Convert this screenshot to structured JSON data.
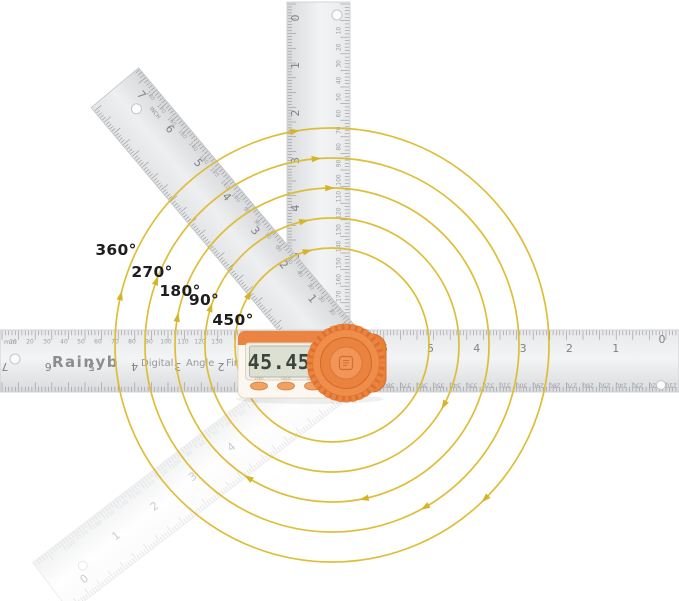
{
  "brand": {
    "name": "Rainyb",
    "descriptor": [
      "Digital",
      "Angle",
      "Finder"
    ]
  },
  "display": {
    "value": "45.45",
    "unit": "°"
  },
  "device_buttons": [
    {
      "label": "ZERO"
    },
    {
      "label": "HOLD"
    },
    {
      "label": "ON/OFF"
    }
  ],
  "rotation_labels": [
    "360°",
    "270°",
    "180°",
    "90°",
    "450°"
  ],
  "colors": {
    "arc_yellow": "#dcba2e",
    "arrow_yellow": "#d6b42a",
    "device_orange": "#ea8440",
    "lcd_screen": "#dce0d3",
    "steel_tick": "#94979b",
    "label_text": "#1e1e1e"
  },
  "rulers": {
    "horizontal": {
      "unit_label": "mm",
      "mm_top": [
        10,
        20,
        30,
        40,
        50,
        60,
        70,
        80,
        90,
        100,
        110,
        120,
        130
      ],
      "inch_right": [
        6,
        5,
        4,
        3,
        2,
        1,
        0
      ],
      "inch_left_flipped": [
        7,
        6,
        5,
        4,
        3,
        2
      ],
      "mm_bottom_flipped": [
        210,
        220,
        230,
        240,
        250,
        260,
        270,
        280,
        290,
        300,
        310,
        320,
        330,
        340,
        350,
        360,
        370,
        380
      ]
    },
    "vertical": {
      "inch": [
        0,
        1,
        2,
        3,
        4,
        5
      ],
      "mm": [
        10,
        20,
        30,
        40,
        50,
        60,
        70,
        80,
        90,
        100,
        110,
        120,
        130,
        140,
        150,
        160,
        170,
        180,
        190
      ]
    },
    "diagonal": {
      "unit_label": "INCH",
      "inch": [
        1,
        2,
        3,
        4,
        5,
        6,
        7
      ],
      "mm": [
        10,
        20,
        30,
        40,
        50,
        60,
        70,
        80,
        90,
        100,
        110,
        120,
        130,
        140,
        150,
        160,
        170,
        180
      ]
    },
    "ghost": {
      "inch": [
        0,
        1,
        2,
        3,
        4
      ],
      "mm": [
        10,
        20,
        30,
        40,
        50,
        60,
        70,
        80,
        90,
        100,
        110,
        120,
        130,
        140,
        150,
        160,
        170,
        180
      ]
    }
  }
}
